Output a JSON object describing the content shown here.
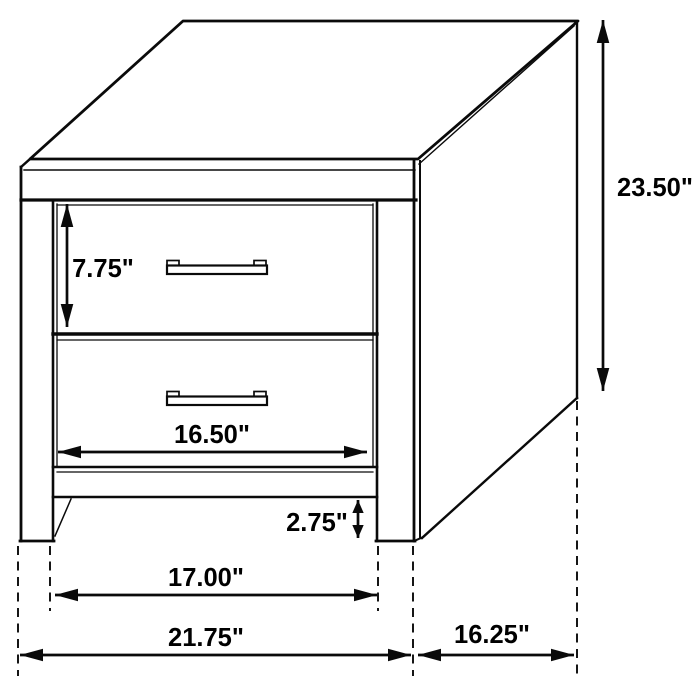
{
  "dimensions": {
    "total_height": "23.50\"",
    "top_drawer_height": "7.75\"",
    "drawer_width": "16.50\"",
    "base_clearance": "2.75\"",
    "leg_inner_span": "17.00\"",
    "overall_width": "21.75\"",
    "depth": "16.25\""
  },
  "colors": {
    "line": "#0a0a0a",
    "background": "#ffffff"
  }
}
